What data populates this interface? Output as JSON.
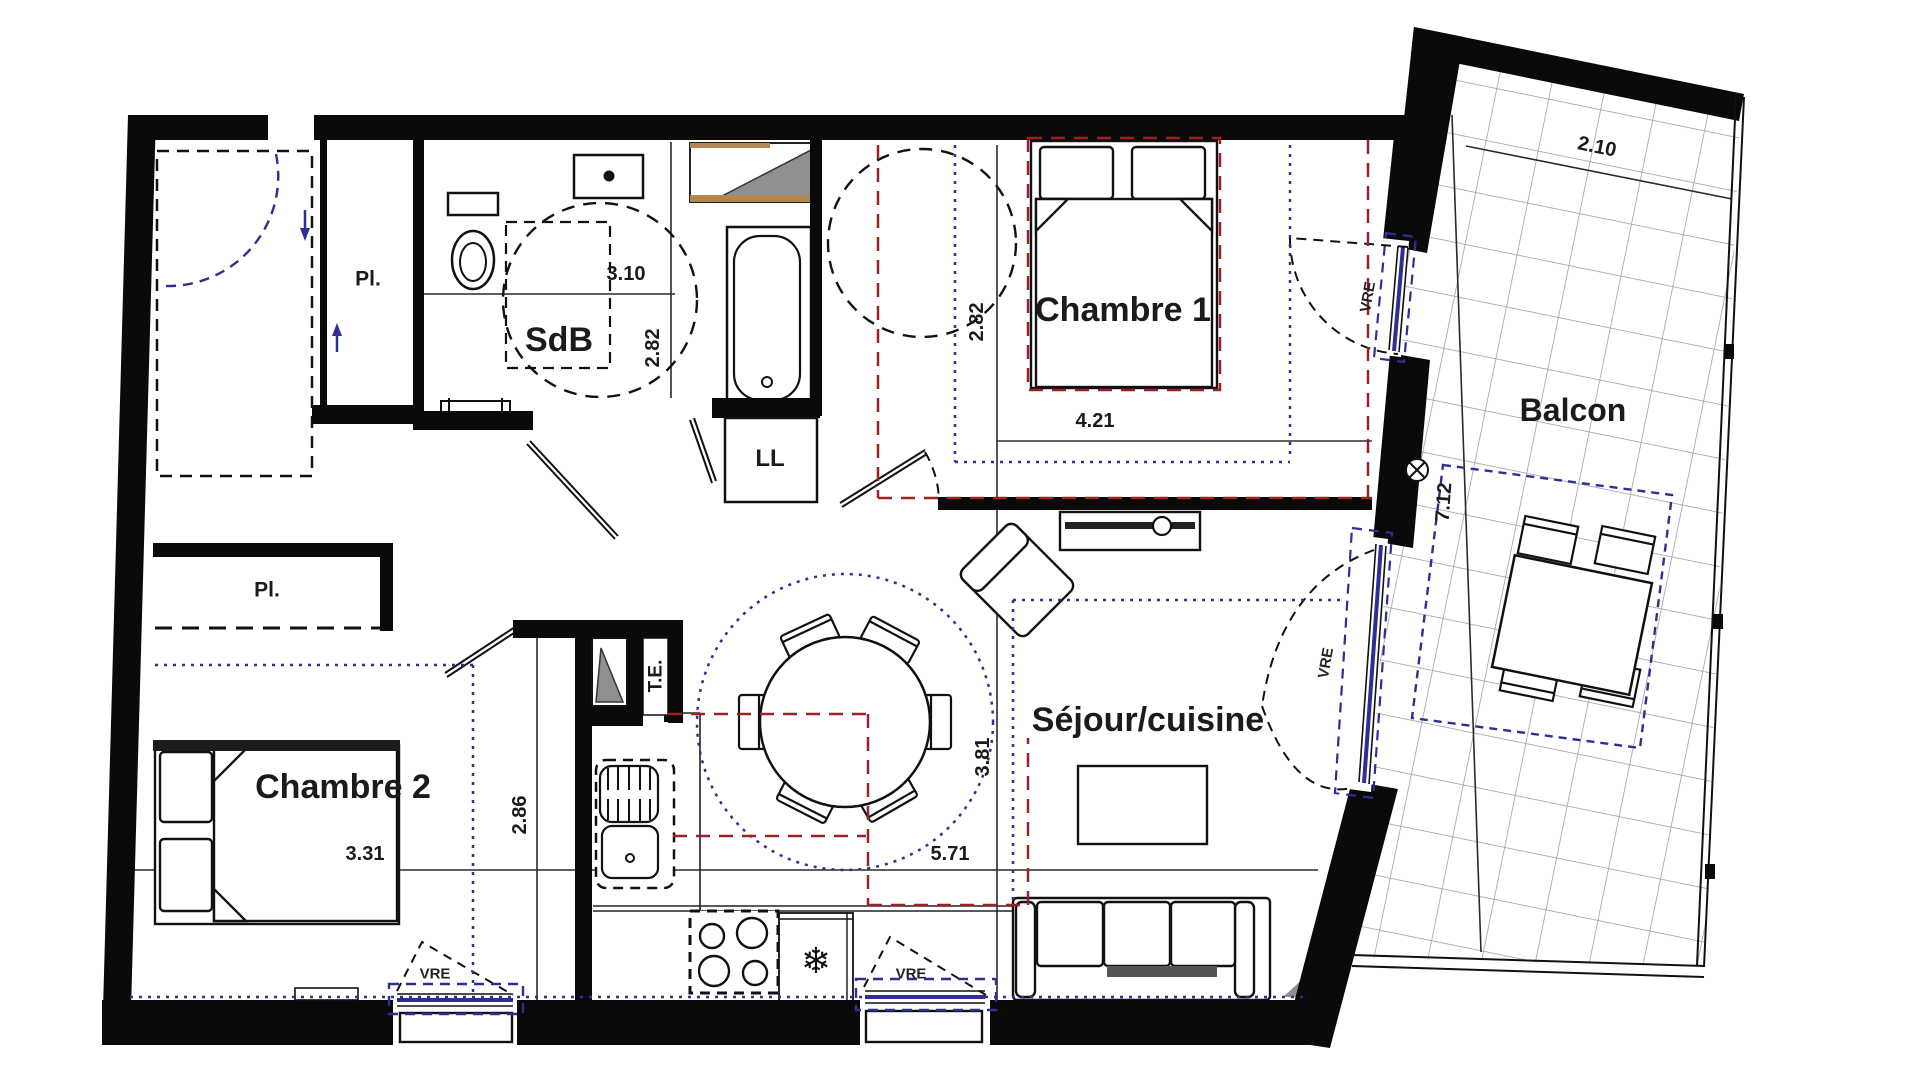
{
  "labels": {
    "sdb": "SdB",
    "chambre1": "Chambre 1",
    "chambre2": "Chambre 2",
    "sejour": "Séjour/cuisine",
    "balcon": "Balcon",
    "pl_entree": "Pl.",
    "pl_chambre2": "Pl.",
    "ll": "LL",
    "te": "T.E."
  },
  "dims": {
    "sdb_w": "3.10",
    "sdb_h": "2.82",
    "ch1_w": "4.21",
    "ch1_h": "2.82",
    "ch2_w": "3.31",
    "ch2_h": "2.86",
    "sejour_w": "5.71",
    "sejour_h": "3.81",
    "balcon_w": "2.10",
    "balcon_l": "7.12"
  },
  "windows": {
    "vre_chambre1": "VRE",
    "vre_sejour_balcon": "VRE",
    "vre_chambre2": "VRE",
    "vre_sejour_sud": "VRE"
  },
  "icons": {
    "fridge": "❄"
  },
  "colors": {
    "wall": "#0a0a0a",
    "zone_blue": "#2e2e96",
    "zone_red": "#9a2222",
    "tile_grid": "#9a9a9a",
    "duct_gray": "#8f8f8f",
    "wood": "#b5854f"
  }
}
